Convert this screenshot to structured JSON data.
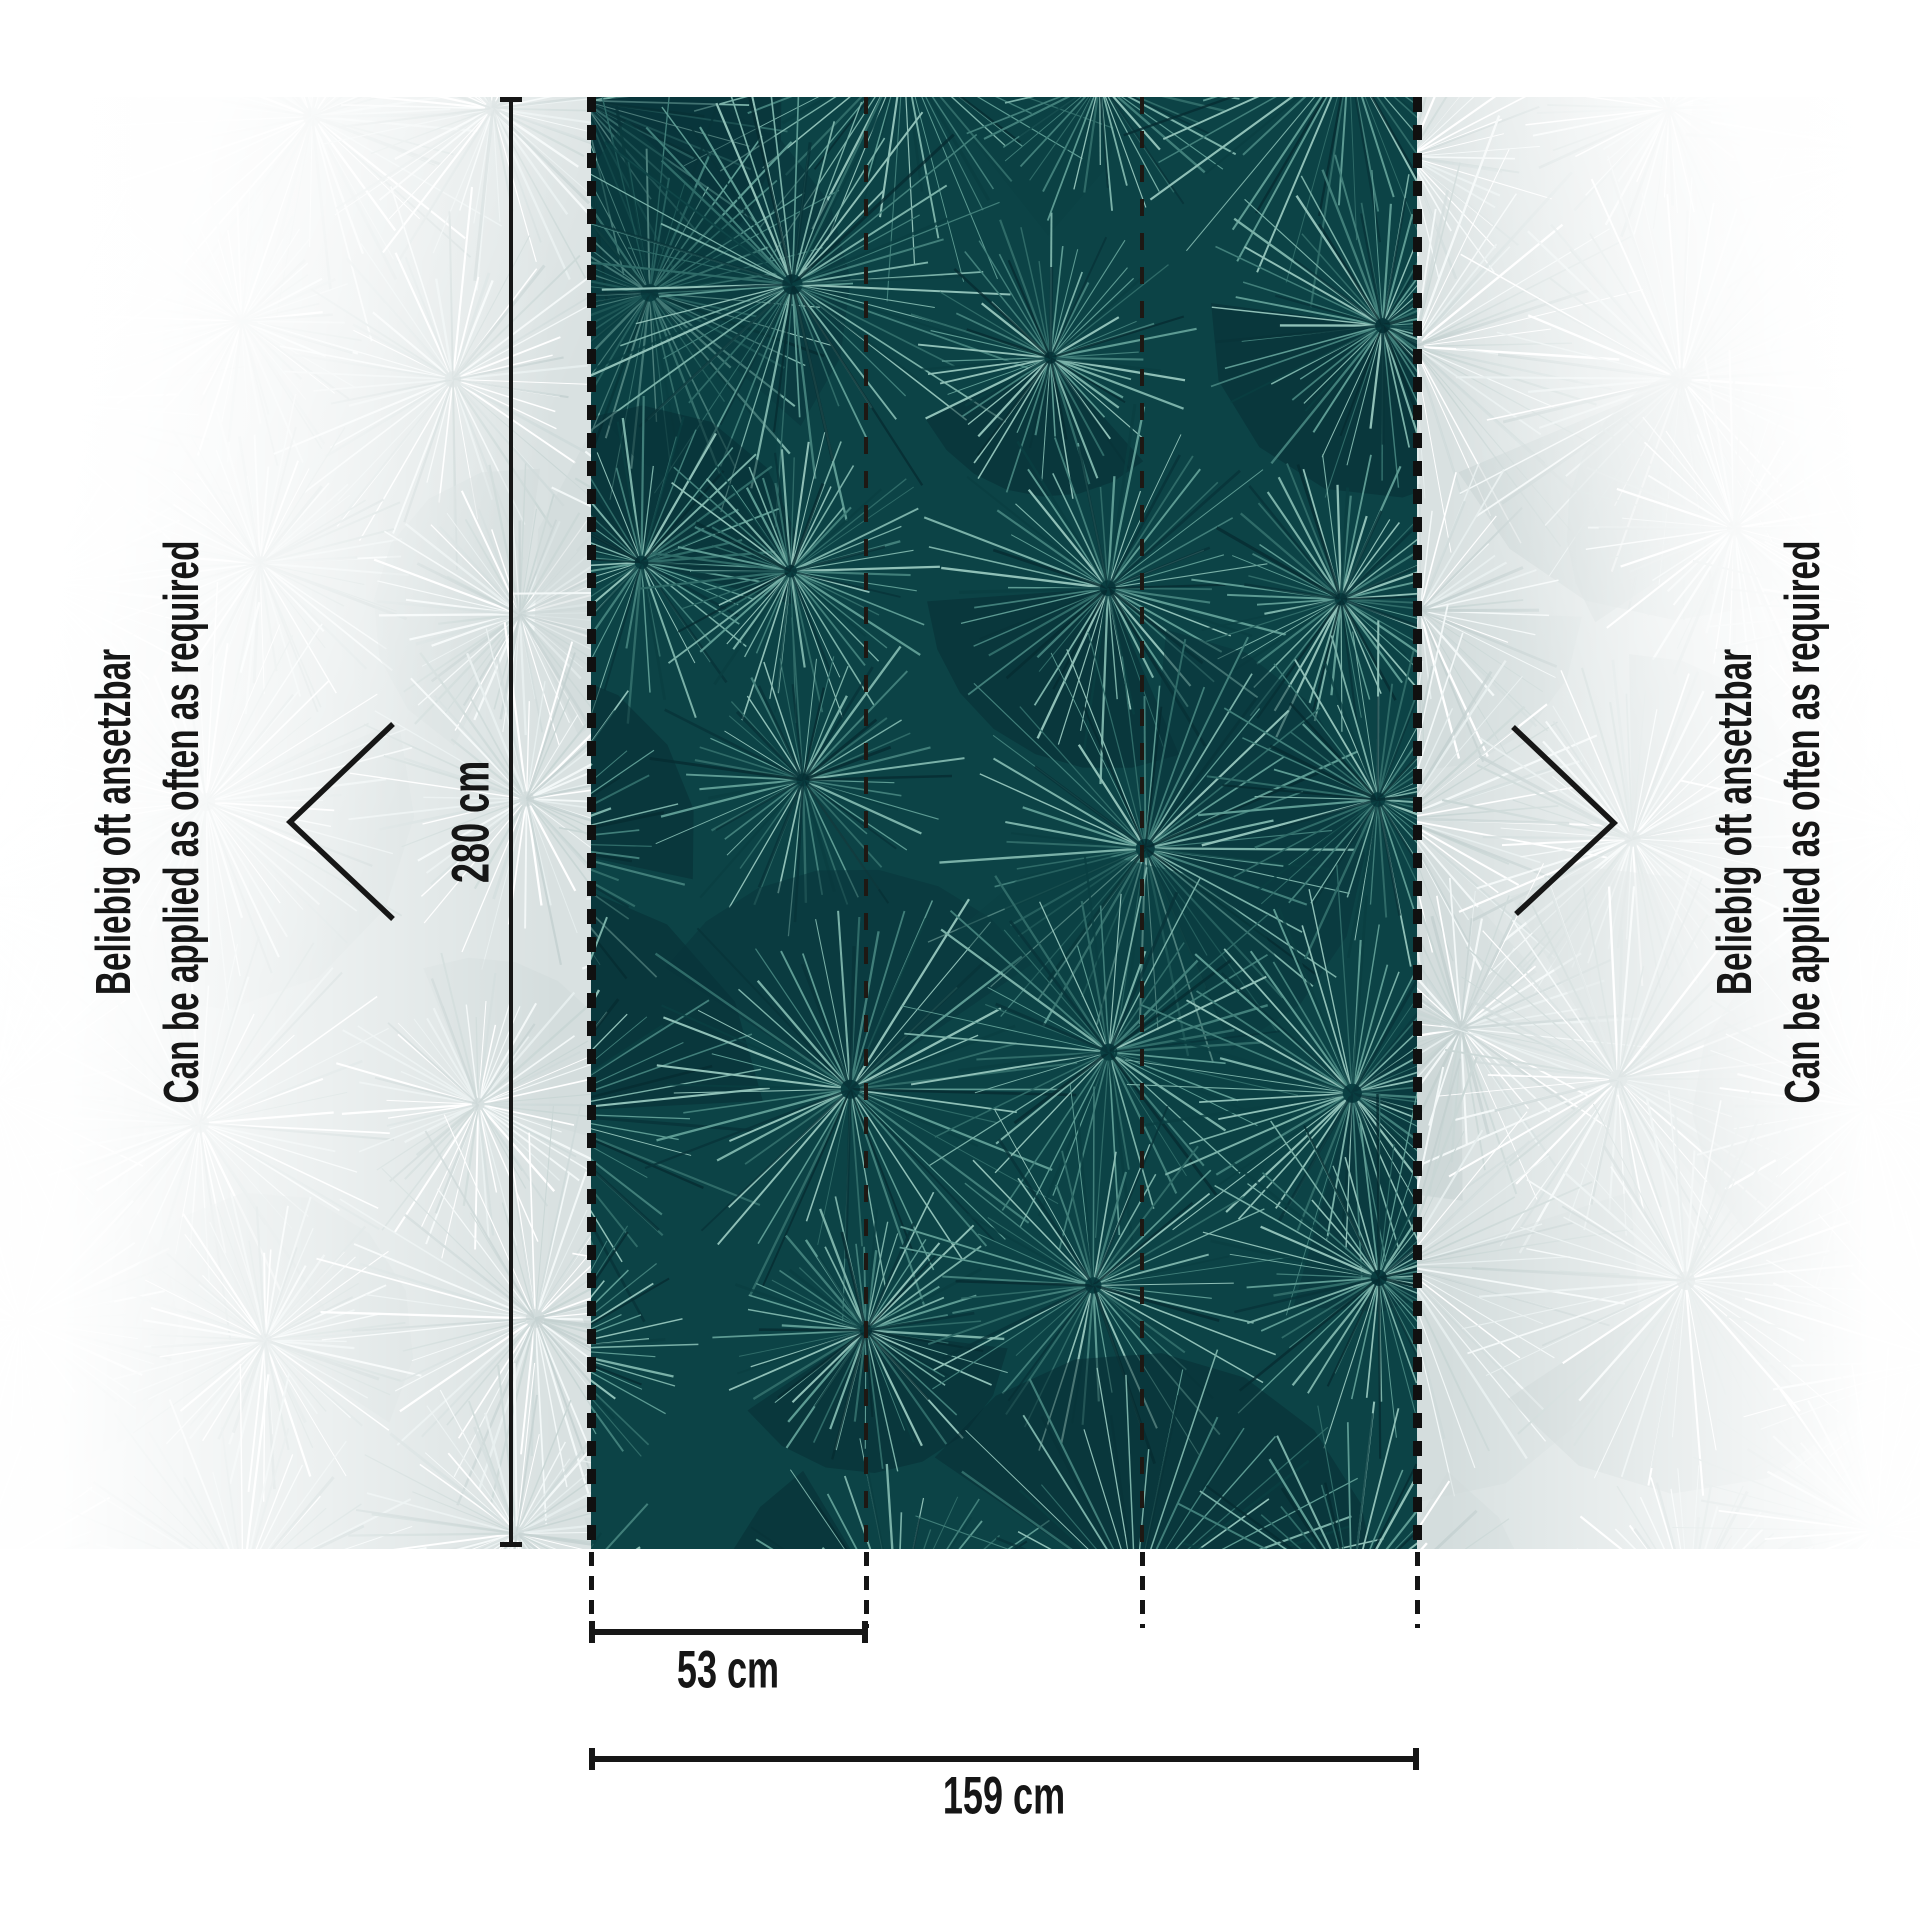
{
  "labels": {
    "height": "280 cm",
    "strip_width": "53 cm",
    "total_width": "159 cm"
  },
  "side_note": {
    "de": "Beliebig oft ansetzbar",
    "en": "Can be applied as often as required"
  },
  "colors": {
    "ink": "#161616",
    "panel_bg": "#0c4346",
    "panel_lights": [
      "#7ab1a8",
      "#5d9b93",
      "#8fc0b7",
      "#417f7a",
      "#2f6b68"
    ],
    "panel_darks": [
      "#062c31",
      "#083439",
      "#0a3f42"
    ],
    "faded_bg": "#d9e1e1",
    "faded_lights": [
      "#f3f8f8",
      "#ffffff",
      "#e6eeee",
      "#c9d6d5"
    ],
    "faded_darks": [
      "#c3d0d0",
      "#cfdada"
    ],
    "seam_dash": "#1e1813",
    "edge_dash": "#101010"
  }
}
